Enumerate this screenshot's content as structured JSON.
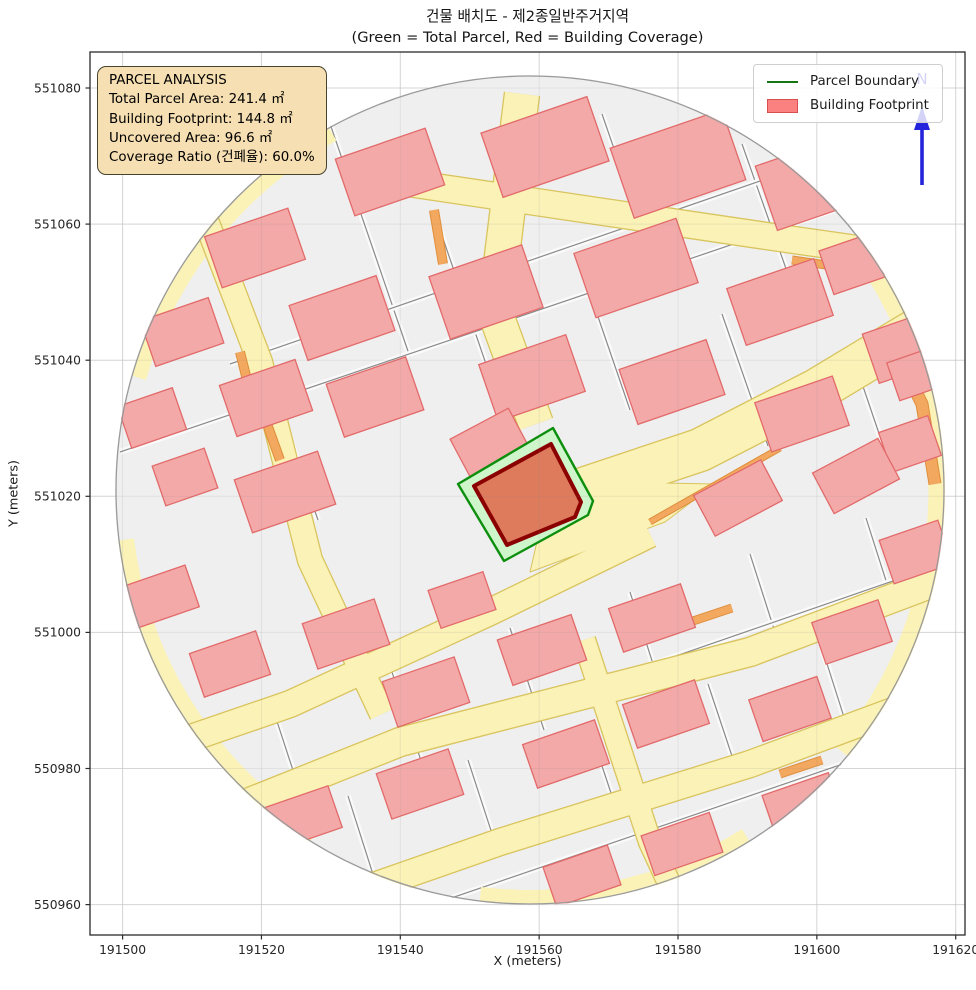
{
  "title": {
    "line1": "건물 배치도 - 제2종일반주거지역",
    "line2": "(Green = Total Parcel, Red = Building Coverage)"
  },
  "axes": {
    "x_label": "X (meters)",
    "y_label": "Y (meters)",
    "x_ticks": [
      "191500",
      "191520",
      "191540",
      "191560",
      "191580",
      "191600",
      "191620"
    ],
    "y_ticks": [
      "551080",
      "551060",
      "551040",
      "551020",
      "551000",
      "550980",
      "550960"
    ]
  },
  "info_box": {
    "title": "PARCEL ANALYSIS",
    "lines": [
      "Total Parcel Area: 241.4 ㎡",
      "Building Footprint: 144.8 ㎡",
      "Uncovered Area: 96.6 ㎡",
      "Coverage Ratio (건폐율): 60.0%"
    ]
  },
  "legend": {
    "items": [
      {
        "label": "Parcel Boundary",
        "swatch": "green-line"
      },
      {
        "label": "Building Footprint",
        "swatch": "red-patch"
      }
    ]
  },
  "north_arrow": {
    "label": "N"
  },
  "chart_data": {
    "type": "map",
    "title": "건물 배치도 - 제2종일반주거지역",
    "subtitle": "(Green = Total Parcel, Red = Building Coverage)",
    "x_axis": {
      "label": "X (meters)",
      "ticks": [
        191500,
        191520,
        191540,
        191560,
        191580,
        191600,
        191620
      ],
      "range": [
        191495.3,
        191621.3
      ]
    },
    "y_axis": {
      "label": "Y (meters)",
      "ticks": [
        551080,
        551060,
        551040,
        551020,
        551000,
        550980,
        550960
      ],
      "range": [
        550955.6,
        551085.3
      ]
    },
    "legend_entries": [
      "Parcel Boundary",
      "Building Footprint"
    ],
    "analysis": {
      "zoning": "제2종일반주거지역",
      "total_parcel_area_m2": 241.4,
      "building_footprint_m2": 144.8,
      "uncovered_area_m2": 96.6,
      "coverage_ratio_pct": 60.0
    },
    "map_extent_shape": "circle clipped cadastral map centered on target parcel"
  },
  "colors": {
    "road_fill": "#FAF2B6",
    "road_edge": "#D9C45E",
    "orange_fill": "#F2A85E",
    "orange_edge": "#DE8E3C",
    "building_fill": "#F4A9A9",
    "building_edge": "#E26A6A",
    "parcel_bg": "#EFEFEF",
    "parcel_line": "#8a8a8a",
    "highlight_parcel_fill": "#CFF5CB",
    "highlight_parcel_edge": "#0D8F0D",
    "footprint_fill": "#DD7B5C",
    "footprint_edge": "#8B0000",
    "north": "#2424DC",
    "grid": "#E2E2E2",
    "spine": "#2b2b2b"
  },
  "map": {
    "circle": {
      "cx": 440,
      "cy": 438,
      "r": 415
    },
    "rim_arcs": [
      {
        "a1": -32,
        "a2": 42,
        "w": 17
      },
      {
        "a1": 122,
        "a2": 173,
        "w": 16
      },
      {
        "a1": 196,
        "a2": 242,
        "w": 15
      },
      {
        "a1": 58,
        "a2": 98,
        "w": 14
      }
    ],
    "lanes": [
      [
        [
          236,
          60
        ],
        [
          320,
          305
        ]
      ],
      [
        [
          512,
          62
        ],
        [
          565,
          215
        ]
      ],
      [
        [
          652,
          92
        ],
        [
          700,
          228
        ]
      ],
      [
        [
          786,
          142
        ],
        [
          822,
          248
        ]
      ],
      [
        [
          150,
          242
        ],
        [
          228,
          468
        ]
      ],
      [
        [
          348,
          172
        ],
        [
          420,
          382
        ]
      ],
      [
        [
          492,
          218
        ],
        [
          540,
          358
        ]
      ],
      [
        [
          632,
          262
        ],
        [
          678,
          394
        ]
      ],
      [
        [
          762,
          302
        ],
        [
          798,
          408
        ]
      ],
      [
        [
          180,
          648
        ],
        [
          214,
          752
        ]
      ],
      [
        [
          300,
          614
        ],
        [
          334,
          718
        ]
      ],
      [
        [
          420,
          576
        ],
        [
          454,
          678
        ]
      ],
      [
        [
          540,
          540
        ],
        [
          572,
          640
        ]
      ],
      [
        [
          660,
          502
        ],
        [
          692,
          602
        ]
      ],
      [
        [
          776,
          466
        ],
        [
          806,
          560
        ]
      ],
      [
        [
          258,
          744
        ],
        [
          288,
          838
        ]
      ],
      [
        [
          378,
          708
        ],
        [
          408,
          800
        ]
      ],
      [
        [
          498,
          672
        ],
        [
          528,
          762
        ]
      ],
      [
        [
          618,
          632
        ],
        [
          648,
          722
        ]
      ],
      [
        [
          732,
          596
        ],
        [
          760,
          684
        ]
      ],
      [
        [
          30,
          400
        ],
        [
          850,
          122
        ]
      ],
      [
        [
          140,
          312
        ],
        [
          812,
          80
        ]
      ],
      [
        [
          100,
          772
        ],
        [
          852,
          512
        ]
      ],
      [
        [
          262,
          880
        ],
        [
          852,
          678
        ]
      ]
    ],
    "roads": [
      {
        "pts": [
          [
            -10,
            724
          ],
          [
            200,
            652
          ],
          [
            400,
            560
          ],
          [
            560,
            482
          ]
        ],
        "w": 26
      },
      {
        "pts": [
          [
            448,
            452
          ],
          [
            610,
            398
          ],
          [
            727,
            338
          ],
          [
            830,
            276
          ]
        ],
        "w": 42
      },
      {
        "pts": [
          [
            55,
            792
          ],
          [
            310,
            690
          ],
          [
            660,
            600
          ],
          [
            872,
            520
          ]
        ],
        "w": 28
      },
      {
        "pts": [
          [
            175,
            872
          ],
          [
            410,
            790
          ],
          [
            660,
            712
          ],
          [
            860,
            638
          ]
        ],
        "w": 26
      },
      {
        "pts": [
          [
            395,
            902
          ],
          [
            660,
            820
          ],
          [
            858,
            752
          ]
        ],
        "w": 24
      },
      {
        "pts": [
          [
            298,
            128
          ],
          [
            500,
            158
          ],
          [
            690,
            186
          ],
          [
            872,
            212
          ]
        ],
        "w": 26
      },
      {
        "pts": [
          [
            432,
            42
          ],
          [
            405,
            260
          ],
          [
            446,
            372
          ]
        ],
        "w": 34
      },
      {
        "pts": [
          [
            112,
            158
          ],
          [
            170,
            310
          ],
          [
            220,
            508
          ],
          [
            292,
            662
          ]
        ],
        "w": 24
      },
      {
        "pts": [
          [
            494,
            588
          ],
          [
            560,
            790
          ],
          [
            612,
            902
          ]
        ],
        "w": 22
      }
    ],
    "junction_wedge": [
      [
        440,
        520
      ],
      [
        575,
        470
      ],
      [
        625,
        432
      ],
      [
        520,
        430
      ],
      [
        452,
        468
      ]
    ],
    "orange": [
      {
        "pts": [
          [
            344,
            158
          ],
          [
            353,
            212
          ]
        ],
        "w": 8
      },
      {
        "pts": [
          [
            150,
            300
          ],
          [
            163,
            352
          ]
        ],
        "w": 8
      },
      {
        "pts": [
          [
            172,
            358
          ],
          [
            190,
            408
          ]
        ],
        "w": 8
      },
      {
        "pts": [
          [
            560,
            470
          ],
          [
            690,
            396
          ]
        ],
        "w": 5
      },
      {
        "pts": [
          [
            800,
            287
          ],
          [
            832,
            352
          ],
          [
            845,
            432
          ]
        ],
        "w": 11
      },
      {
        "pts": [
          [
            304,
            656
          ],
          [
            346,
            642
          ]
        ],
        "w": 7
      },
      {
        "pts": [
          [
            600,
            570
          ],
          [
            642,
            556
          ]
        ],
        "w": 7
      },
      {
        "pts": [
          [
            690,
            722
          ],
          [
            732,
            708
          ]
        ],
        "w": 7
      },
      {
        "pts": [
          [
            702,
            208
          ],
          [
            750,
            215
          ]
        ],
        "w": 7
      }
    ],
    "buildings": [
      [
        300,
        120,
        95,
        60
      ],
      [
        455,
        95,
        112,
        68
      ],
      [
        588,
        112,
        118,
        74
      ],
      [
        718,
        132,
        88,
        68
      ],
      [
        762,
        212,
        54,
        46
      ],
      [
        165,
        196,
        88,
        54
      ],
      [
        92,
        280,
        72,
        48
      ],
      [
        252,
        266,
        92,
        58
      ],
      [
        396,
        240,
        98,
        66
      ],
      [
        546,
        216,
        108,
        68
      ],
      [
        690,
        250,
        92,
        60
      ],
      [
        812,
        296,
        66,
        52
      ],
      [
        176,
        346,
        80,
        54
      ],
      [
        62,
        366,
        58,
        44
      ],
      [
        285,
        345,
        84,
        56
      ],
      [
        442,
        326,
        92,
        60
      ],
      [
        582,
        330,
        92,
        58
      ],
      [
        712,
        362,
        82,
        52
      ],
      [
        820,
        392,
        52,
        42
      ],
      [
        95,
        425,
        55,
        42
      ],
      [
        195,
        440,
        88,
        56
      ],
      [
        400,
        392,
        66,
        46,
        -28
      ],
      [
        372,
        548,
        58,
        40
      ],
      [
        648,
        446,
        76,
        46,
        -28
      ],
      [
        766,
        424,
        74,
        46,
        -28
      ],
      [
        826,
        500,
        62,
        46
      ],
      [
        70,
        545,
        68,
        44
      ],
      [
        140,
        612,
        70,
        46
      ],
      [
        256,
        582,
        76,
        48
      ],
      [
        336,
        640,
        76,
        48
      ],
      [
        452,
        598,
        78,
        48
      ],
      [
        562,
        566,
        76,
        46
      ],
      [
        212,
        766,
        70,
        44
      ],
      [
        330,
        732,
        76,
        48
      ],
      [
        476,
        702,
        76,
        46
      ],
      [
        576,
        662,
        76,
        46
      ],
      [
        700,
        657,
        72,
        44
      ],
      [
        592,
        792,
        72,
        42
      ],
      [
        712,
        752,
        70,
        42
      ],
      [
        762,
        580,
        70,
        44
      ],
      [
        492,
        824,
        68,
        42
      ],
      [
        826,
        322,
        48,
        40
      ]
    ],
    "building_angle": -19,
    "highlight_parcel": [
      [
        463,
        376
      ],
      [
        368,
        432
      ],
      [
        414,
        509
      ],
      [
        498,
        463
      ],
      [
        503,
        449
      ]
    ],
    "footprint": [
      [
        461,
        392
      ],
      [
        384,
        434
      ],
      [
        417,
        493
      ],
      [
        485,
        465
      ],
      [
        491,
        450
      ]
    ]
  },
  "layout_px": {
    "plot": {
      "left": 90,
      "top": 52,
      "width": 875,
      "height": 883
    },
    "x_tick0": 32.6,
    "x_tick_step": 138.85,
    "y_tick0": 36.0,
    "y_tick_step": 136.1
  }
}
